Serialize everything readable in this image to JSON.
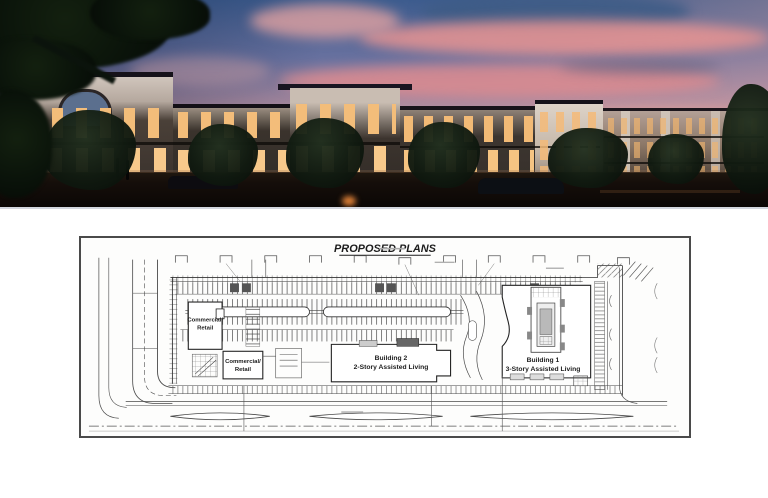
{
  "plan": {
    "title": "PROPOSED PLANS",
    "buildings": {
      "commercial_retail_1": {
        "line1": "Commercial/",
        "line2": "Retail"
      },
      "commercial_retail_2": {
        "line1": "Commercial/",
        "line2": "Retail"
      },
      "building_2": {
        "line1": "Building 2",
        "line2": "2-Story Assisted Living"
      },
      "building_1": {
        "line1": "Building 1",
        "line2": "3-Story Assisted Living"
      }
    }
  },
  "colors": {
    "sky_top_blue": "#3d5c8e",
    "cloud_pink": "#e89a96",
    "sunset_peach": "#e7b3a9",
    "window_glow": "#f6c27d",
    "building_dark": "#332d2b",
    "building_light": "#d7cdc2",
    "plan_line": "#2e2e2e",
    "plan_frame_border": "#4a4a4a",
    "page_background": "#ffffff"
  }
}
